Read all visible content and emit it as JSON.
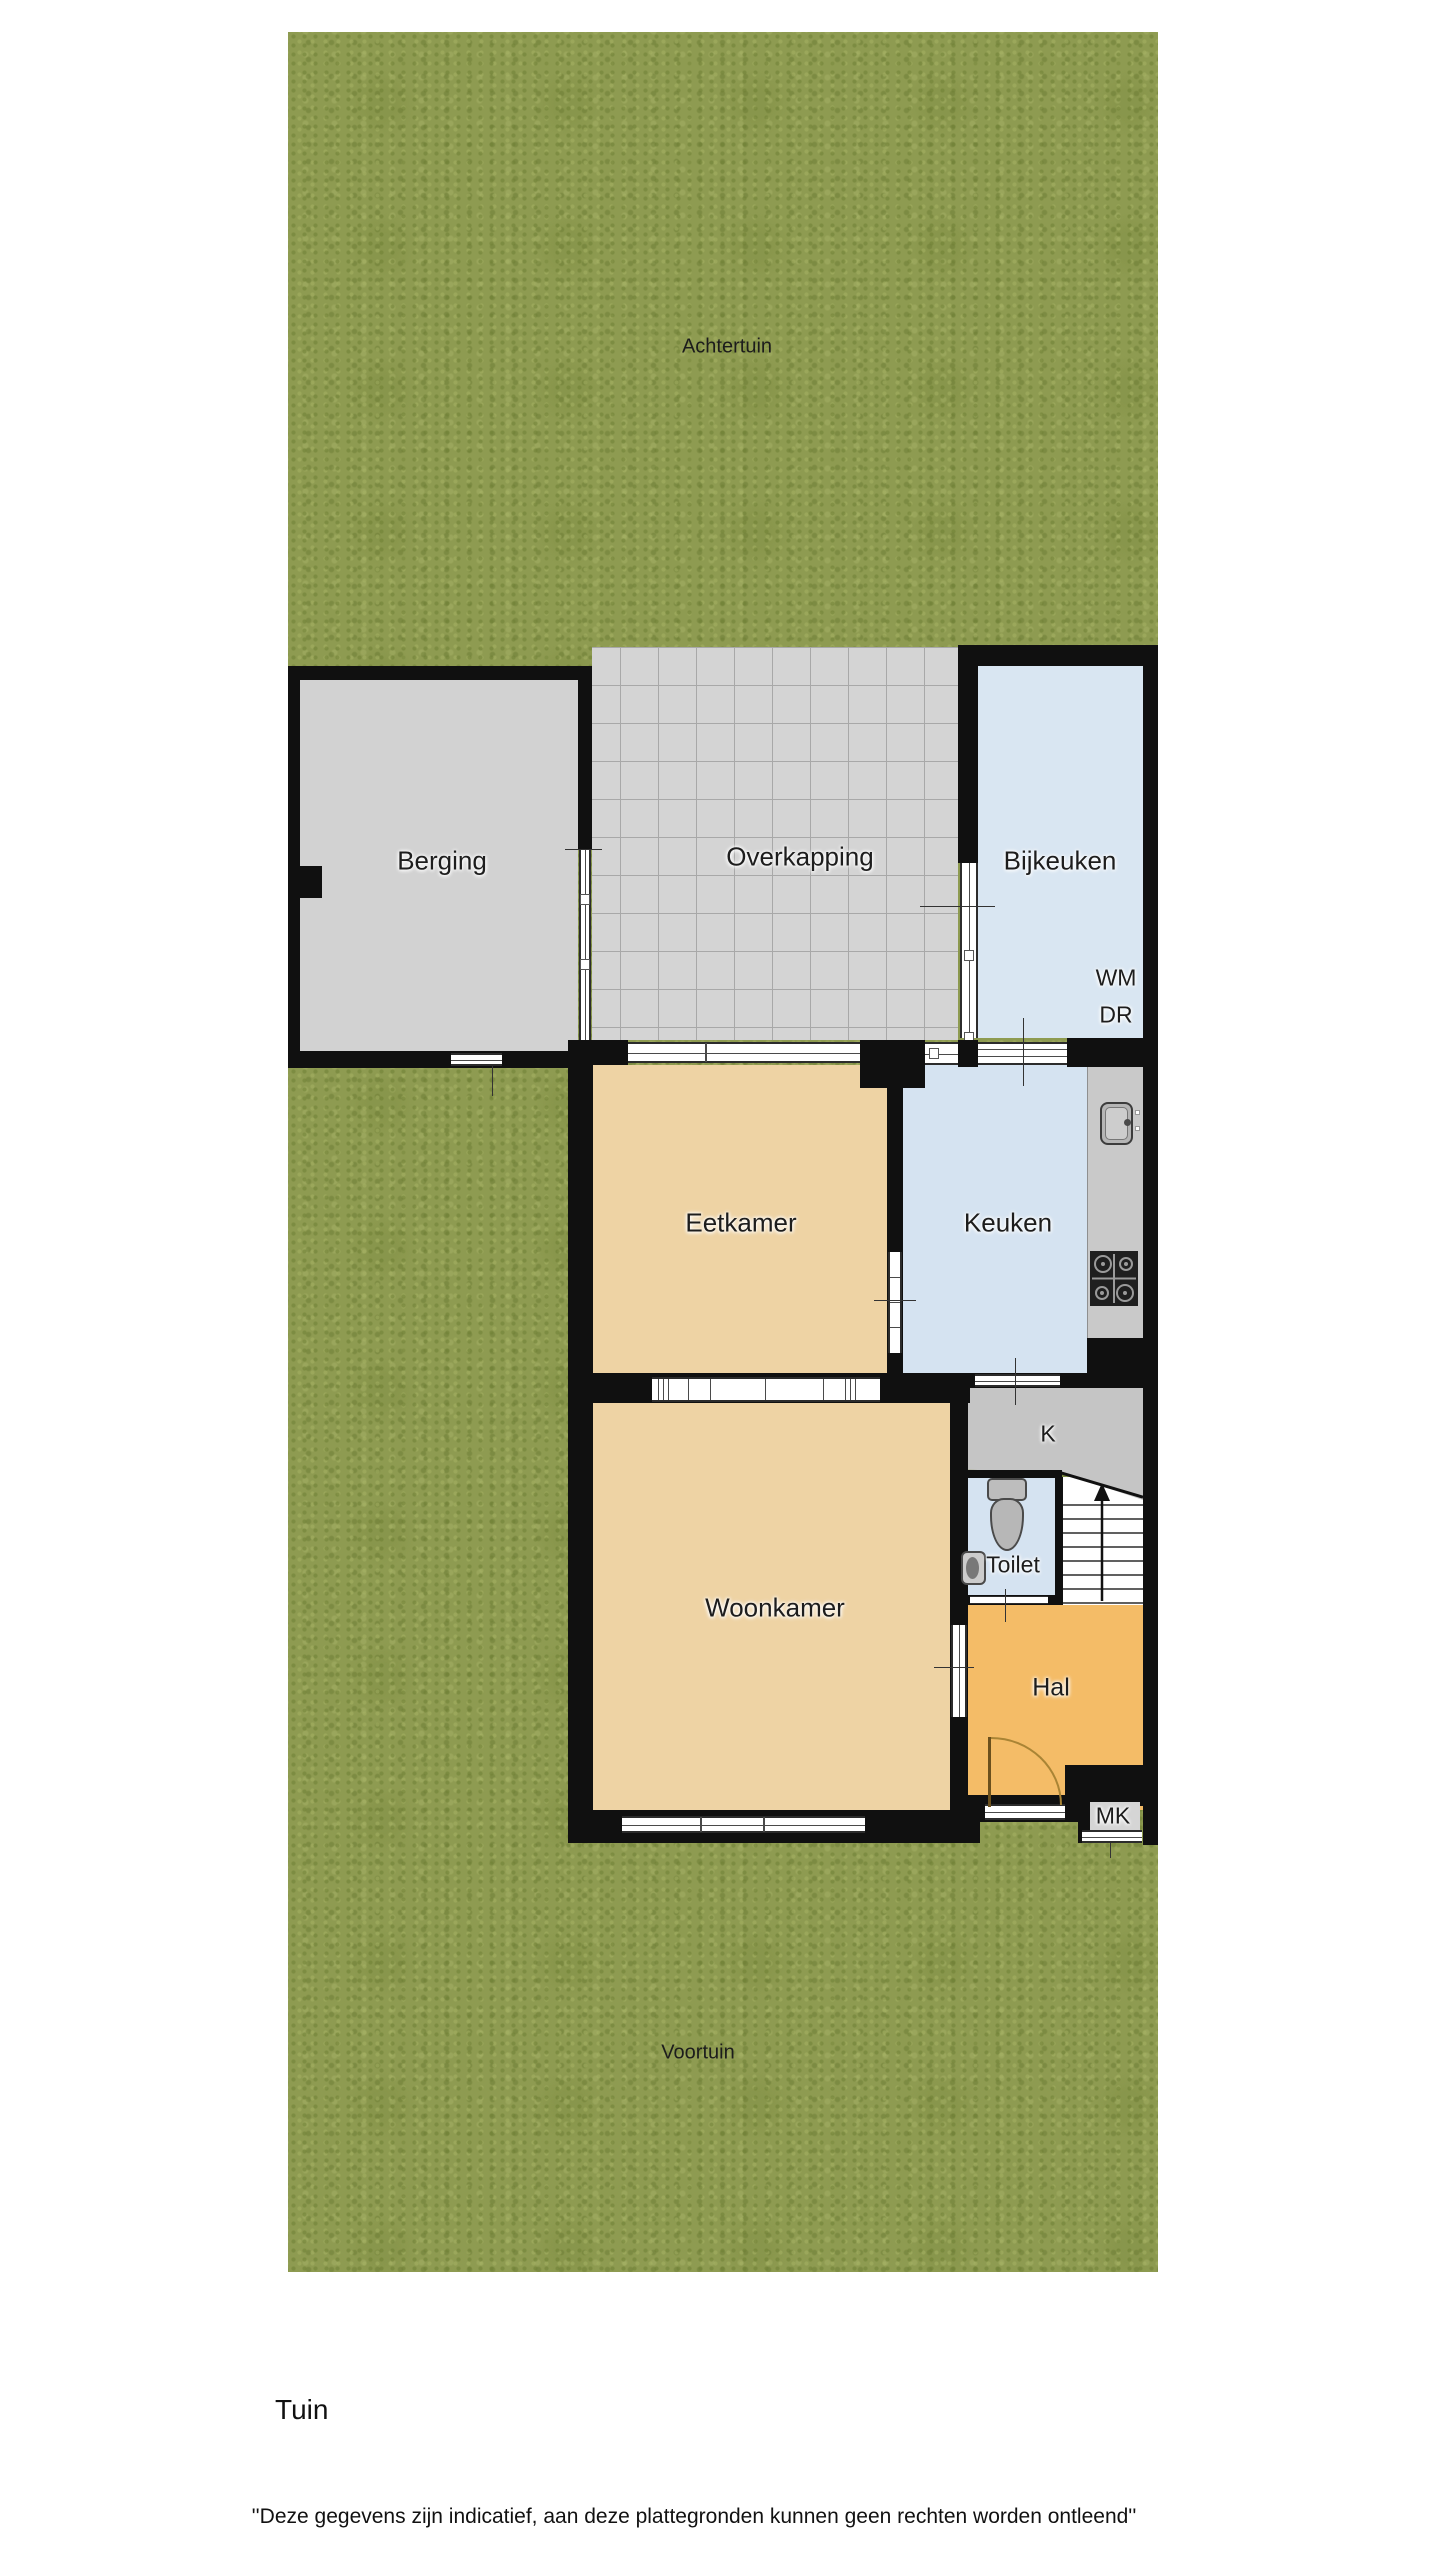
{
  "plan": {
    "garden": {
      "back": "Achtertuin",
      "front": "Voortuin"
    },
    "rooms": {
      "berging": "Berging",
      "overkapping": "Overkapping",
      "bijkeuken": "Bijkeuken",
      "eetkamer": "Eetkamer",
      "keuken": "Keuken",
      "woonkamer": "Woonkamer",
      "kast": "K",
      "toilet": "Toilet",
      "hal": "Hal",
      "meterkast": "MK"
    },
    "appliances": {
      "washing_machine": "WM",
      "dryer": "DR"
    }
  },
  "footer": {
    "caption": "Tuin",
    "disclaimer": "''Deze gegevens zijn indicatief, aan deze plattegronden kunnen geen rechten worden ontleend''"
  },
  "colors": {
    "page": "#ffffff",
    "grass": "#8e9b51",
    "wall": "#101010",
    "storage_floor": "#d2d2d2",
    "canopy_tile": "#d4d4d4",
    "utility_floor": "#d9e6f2",
    "kitchen_floor": "#d5e3f1",
    "dining_floor": "#eed3a4",
    "living_floor": "#eed3a4",
    "hall_floor": "#f4bc67",
    "closet_floor": "#c5c5c5",
    "counter": "#c9c9c9"
  }
}
